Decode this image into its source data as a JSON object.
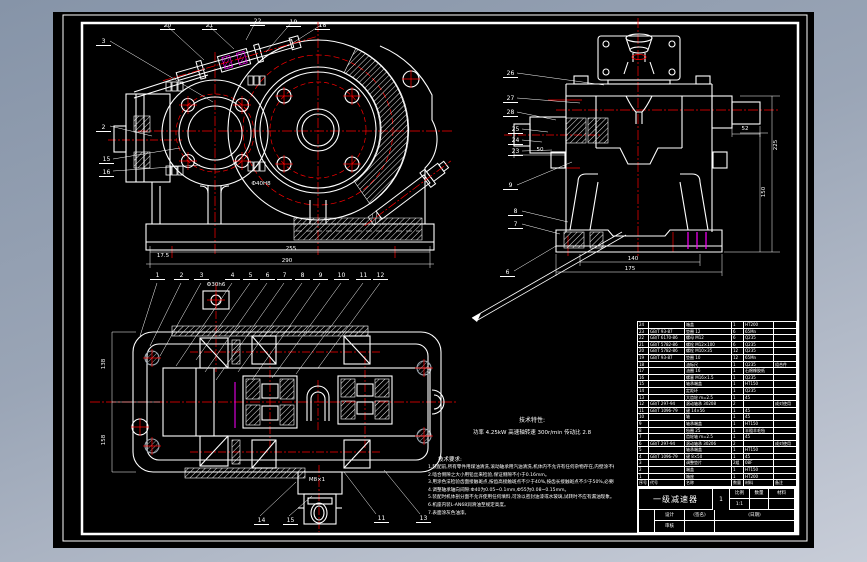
{
  "colors": {
    "background": "#000000",
    "desktop_top": "#8694a8",
    "desktop_bottom": "#c8cdd8",
    "line": "#ffffff",
    "centerline": "#ff0000",
    "accent": "#ff00ff"
  },
  "tech_spec": {
    "heading": "技术特性:",
    "line": "功率 4.25kW   高速轴转速 300r/min   传动比 2.8"
  },
  "tech_req": {
    "heading": "技术要求:",
    "lines": [
      "1.装配前,所有零件用煤油清洗,滚动轴承用汽油清洗,机体内不允许有任何杂物存在,内壁涂不被机油侵蚀的涂料两次。",
      "2.啮合侧隙之大小用铅丝来检验,保证侧隙不小于0.16mm。",
      "3.用涂色法检验齿面接触斑点,按齿高接触斑点不少于40%,按齿长接触斑点不少于50%,必要时可研磨或刮后研磨以改善接触情况。",
      "4.调整轴承轴向间隙:Ф40为0.05~0.1mm,Ф55为0.08~0.15mm。",
      "5.装配时机体剖分面不允许使用任何填料,可涂以密封油漆或水玻璃,试转时不应有漏油现象。",
      "6.机座内装L-AN68润滑油至规定高度。",
      "7.表面涂灰色油漆。"
    ]
  },
  "callouts": {
    "front_top": [
      "20",
      "21",
      "22",
      "19",
      "18"
    ],
    "front_left": [
      "3",
      "2",
      "15",
      "16"
    ],
    "side_left": [
      "26",
      "27",
      "28",
      "25",
      "24",
      "23",
      "9",
      "8",
      "7",
      "6"
    ],
    "top_row": [
      "1",
      "2",
      "3",
      "4",
      "5",
      "6",
      "7",
      "8",
      "9",
      "10",
      "11",
      "12"
    ],
    "bottom_row": [
      "14",
      "15",
      "11",
      "13"
    ]
  },
  "dims": {
    "front_base_inner": "255",
    "front_base_outer": "290",
    "front_base_left": "17.5",
    "front_bore": "Ф40H8",
    "side_left_shaft": "50",
    "side_right_shaft": "52",
    "side_height_total": "225",
    "side_height_foot": "150",
    "side_base_inner": "140",
    "side_base_outer": "175",
    "top_width_upper": "138",
    "top_width_lower": "158",
    "top_boss": "Ф30h6",
    "drain_thread": "M8×1"
  },
  "bom": {
    "headers": [
      "序号",
      "代号",
      "名称",
      "数量",
      "材料",
      "备注"
    ],
    "rows": [
      [
        "24",
        "",
        "箱盖",
        "1",
        "HT200",
        ""
      ],
      [
        "23",
        "GB/T 93-87",
        "垫圈 12",
        "6",
        "65Mn",
        ""
      ],
      [
        "22",
        "GB/T 6170-86",
        "螺母 M12",
        "6",
        "Q235",
        ""
      ],
      [
        "21",
        "GB/T 5782-86",
        "螺栓 M12×100",
        "6",
        "Q235",
        ""
      ],
      [
        "20",
        "GB/T 5782-86",
        "螺栓 M10×35",
        "12",
        "Q235",
        ""
      ],
      [
        "19",
        "GB/T 93-87",
        "垫圈 10",
        "12",
        "65Mn",
        ""
      ],
      [
        "18",
        "",
        "油标尺",
        "1",
        "Q235",
        "组合件"
      ],
      [
        "17",
        "",
        "油圈 16",
        "1",
        "石棉橡胶纸",
        ""
      ],
      [
        "16",
        "",
        "螺塞 M16×1.5",
        "1",
        "Q235",
        ""
      ],
      [
        "15",
        "",
        "轴承端盖",
        "1",
        "HT150",
        ""
      ],
      [
        "14",
        "",
        "定距环",
        "1",
        "Q235",
        ""
      ],
      [
        "13",
        "",
        "大齿轮 m=2.5",
        "1",
        "45",
        ""
      ],
      [
        "12",
        "GB/T 297-94",
        "滚动轴承 30208",
        "2",
        "",
        "成对使用"
      ],
      [
        "11",
        "GB/T 1096-79",
        "键 14×56",
        "1",
        "45",
        ""
      ],
      [
        "10",
        "",
        "轴",
        "1",
        "45",
        ""
      ],
      [
        "9",
        "",
        "轴承端盖",
        "1",
        "HT150",
        ""
      ],
      [
        "8",
        "",
        "毡圈 25",
        "1",
        "半粗羊毛毡",
        ""
      ],
      [
        "7",
        "",
        "齿轮轴 m=2.5",
        "1",
        "45",
        ""
      ],
      [
        "6",
        "GB/T 297-94",
        "滚动轴承 30206",
        "2",
        "",
        "成对使用"
      ],
      [
        "5",
        "",
        "轴承端盖",
        "1",
        "HT150",
        ""
      ],
      [
        "4",
        "GB/T 1096-79",
        "键 8×50",
        "1",
        "45",
        ""
      ],
      [
        "3",
        "",
        "调整垫片",
        "2组",
        "08F",
        ""
      ],
      [
        "2",
        "",
        "端盖",
        "1",
        "HT150",
        ""
      ],
      [
        "1",
        "",
        "箱座",
        "1",
        "HT200",
        ""
      ]
    ]
  },
  "title_block": {
    "title": "一级减速器",
    "scale_label": "比例",
    "scale_value": "1:1",
    "count_label": "数量",
    "count_value": "",
    "material_label": "材料",
    "material_value": "",
    "sheet_no": "1",
    "design_label": "设计",
    "sign_hint": "(签名)",
    "date_hint": "(日期)",
    "check_label": "审核"
  }
}
